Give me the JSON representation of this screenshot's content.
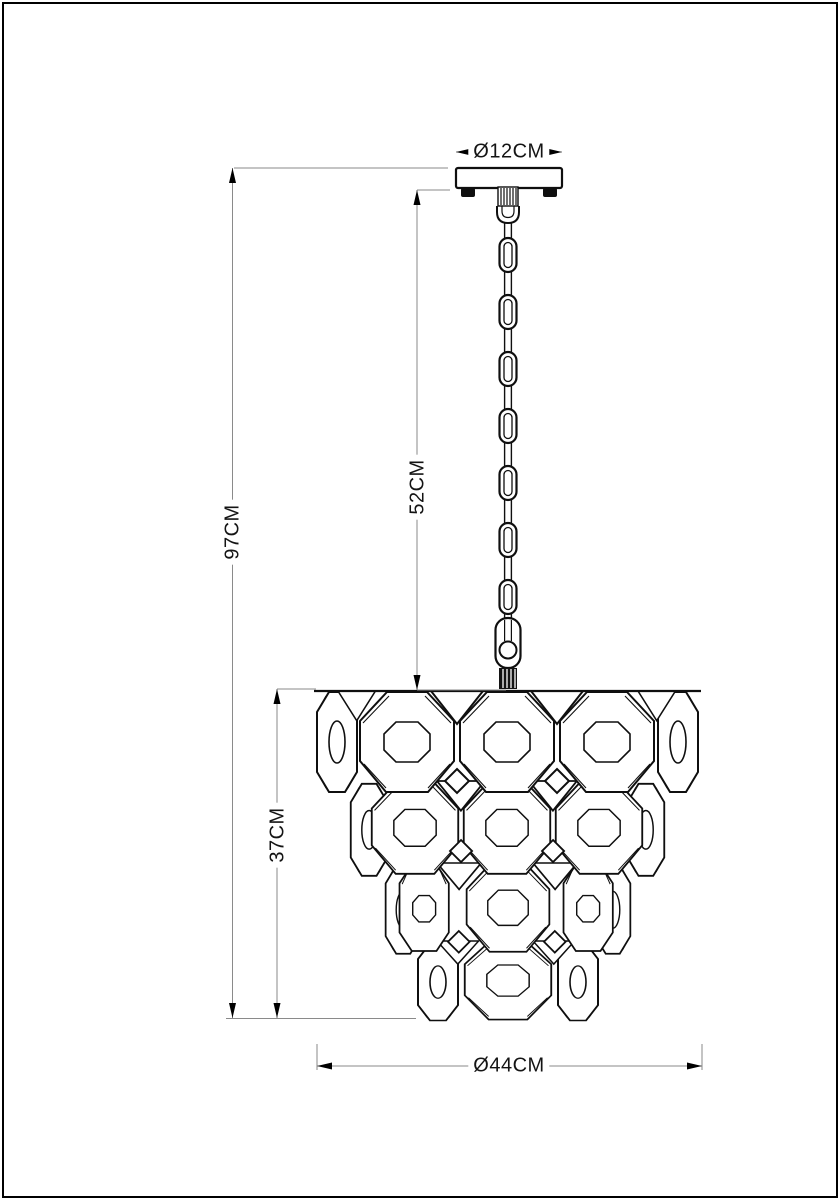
{
  "drawing": {
    "labels": {
      "canopy_diameter": "Ø12CM",
      "overall_height": "97CM",
      "chain_drop": "52CM",
      "shade_height": "37CM",
      "shade_diameter": "Ø44CM"
    },
    "colors": {
      "outline": "#0f0f0f",
      "dimension_line": "#8a8a8a",
      "background": "#ffffff"
    }
  }
}
